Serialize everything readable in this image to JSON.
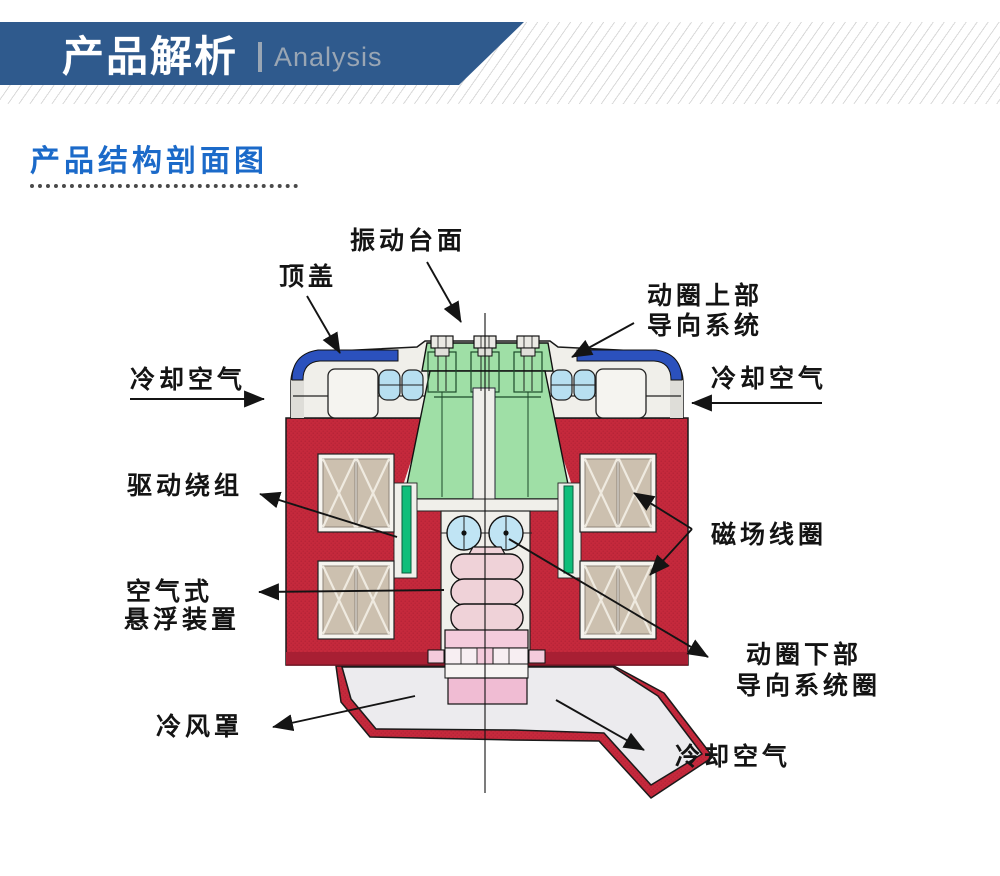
{
  "header": {
    "title": "产品解析",
    "subtitle": "Analysis",
    "banner_color": "#2F5A8D",
    "subtitle_color": "#9AA6B4"
  },
  "section": {
    "title": "产品结构剖面图",
    "title_color": "#1B6AC9"
  },
  "diagram": {
    "description": "electrodynamic-shaker-cross-section",
    "labels": {
      "table_surface": "振动台面",
      "top_cover": "顶盖",
      "coil_upper_guide_line1": "动圈上部",
      "coil_upper_guide_line2": "导向系统",
      "cooling_air_left": "冷却空气",
      "cooling_air_right": "冷却空气",
      "drive_winding": "驱动绕组",
      "field_coil": "磁场线圈",
      "air_suspension_line1": "空气式",
      "air_suspension_line2": "悬浮装置",
      "coil_lower_guide_line1": "动圈下部",
      "coil_lower_guide_line2": "导向系统圈",
      "cooling_hood": "冷风罩",
      "cooling_air_bottom": "冷却空气"
    },
    "colors": {
      "body_red": "#C5293C",
      "armature_green": "#9FDFA6",
      "winding_green": "#0FBE7A",
      "cap_blue": "#2B51BD",
      "roller_blue": "#B7DFF0",
      "bearing_blue": "#C0E4F4",
      "coil_tan": "#CCC0AF",
      "bellows_pink": "#EFD2D8",
      "block_pink": "#F0BCD3"
    }
  }
}
